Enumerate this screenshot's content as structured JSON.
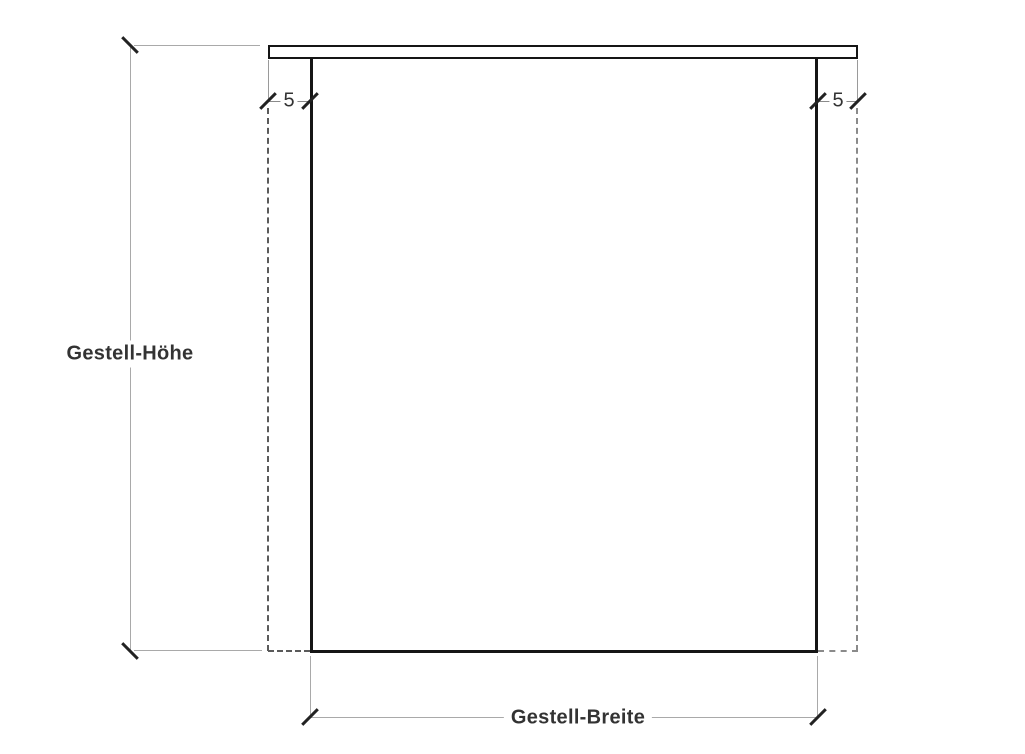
{
  "diagram": {
    "kind": "technical-dimension-drawing",
    "subject": "table frame front elevation",
    "labels": {
      "height": "Gestell-Höhe",
      "width": "Gestell-Breite",
      "overhang_left": "5",
      "overhang_right": "5"
    },
    "colors": {
      "object_line": "#151515",
      "dimension_line": "#a9a9a9",
      "projection_dashed_line": "#5a5a5a",
      "tick_mark": "#222222",
      "text": "#333333",
      "background": "#ffffff"
    }
  }
}
